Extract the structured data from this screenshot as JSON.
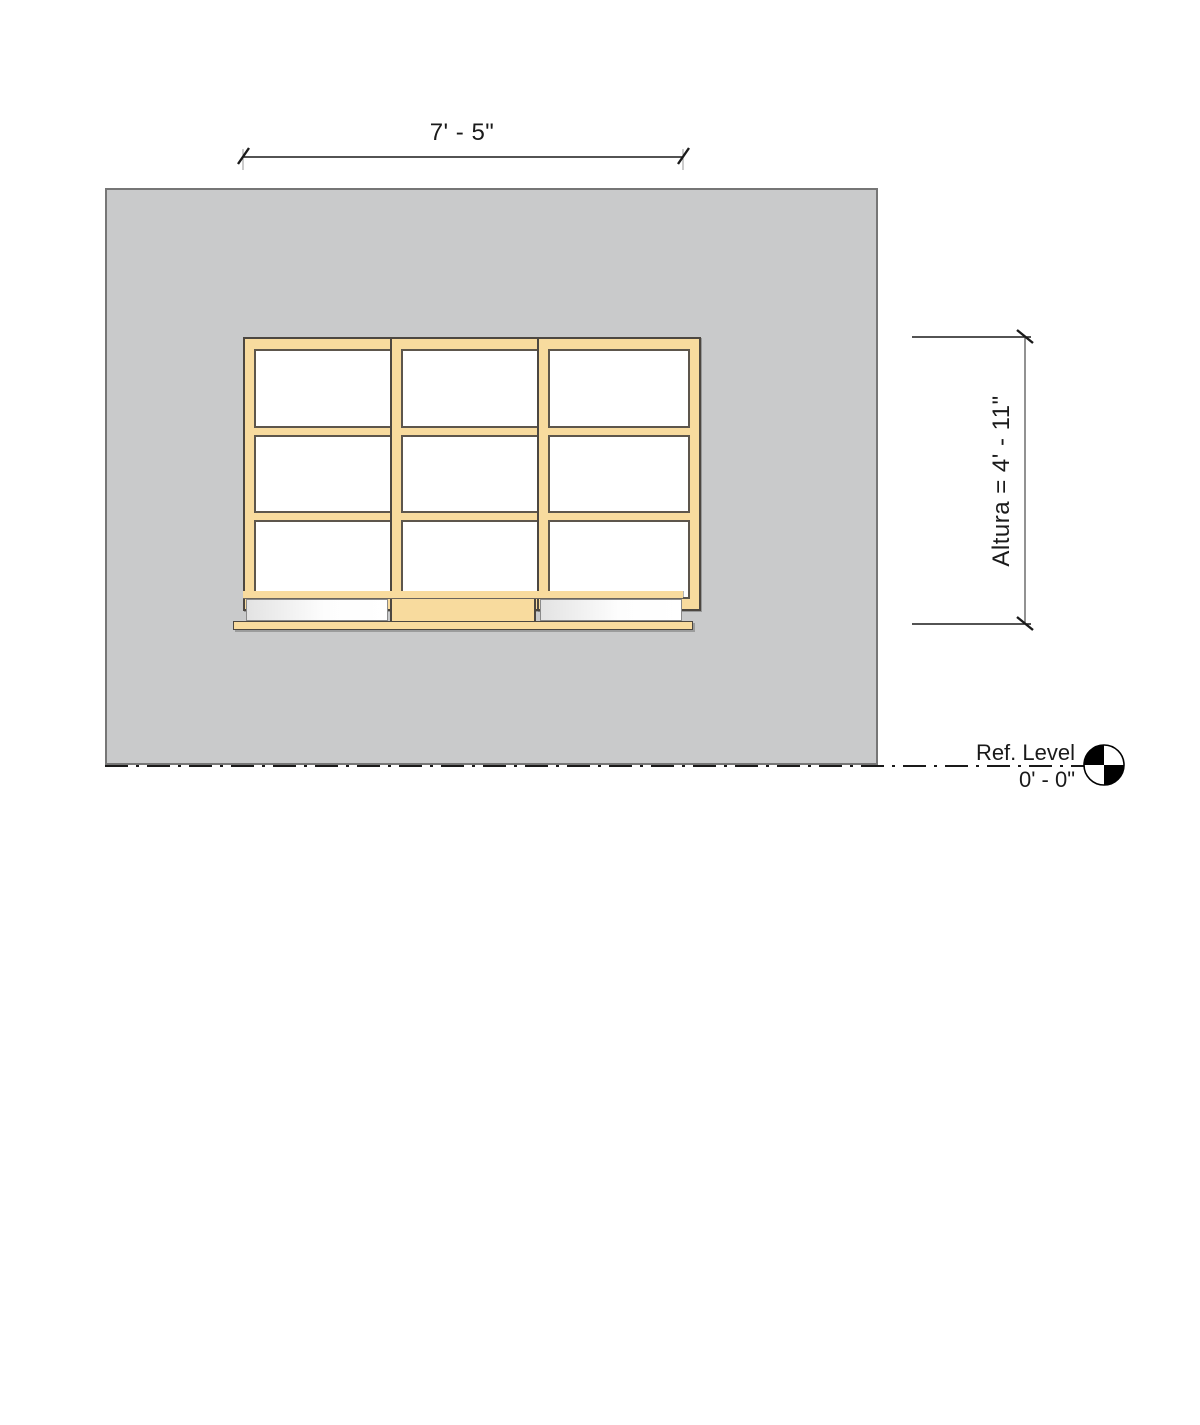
{
  "view": {
    "type": "window-elevation-drawing",
    "background": "#FFFFFF"
  },
  "dimensions": {
    "width_label": "7' - 5\"",
    "height_label": "Altura = 4' - 11\""
  },
  "level": {
    "name": "Ref. Level",
    "elevation": "0' - 0\"",
    "marker_icon": "level-head-target-icon",
    "line_style": "dash-dot"
  },
  "window": {
    "panels": 3,
    "panes_per_panel": 3,
    "has_sill": true
  },
  "colors": {
    "wall_fill": "#C9CACB",
    "wall_border": "#767676",
    "frame_fill": "#F8DB9E",
    "frame_border": "#4C4741",
    "pane_fill": "#FFFFFF",
    "annotation": "#1A1A1A"
  }
}
